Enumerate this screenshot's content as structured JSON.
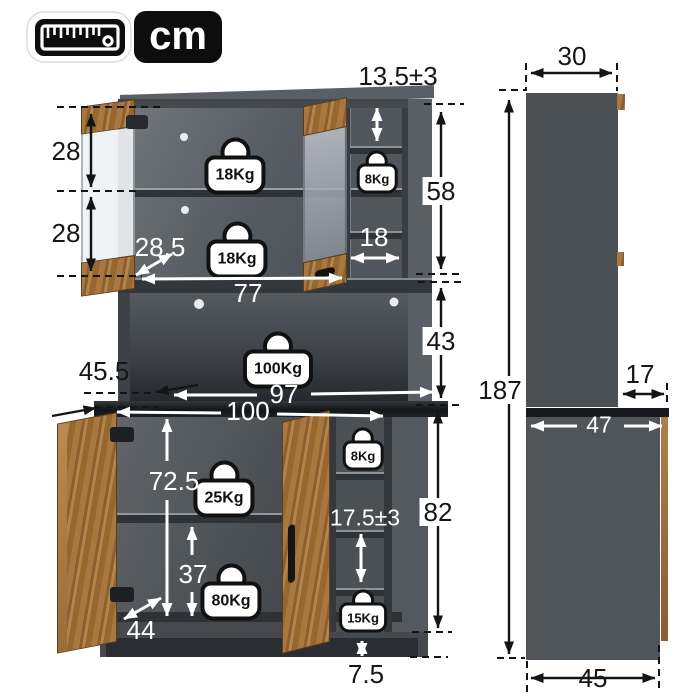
{
  "unit_badge": {
    "ruler_icon": "ruler-icon",
    "unit": "cm"
  },
  "front_view": {
    "dims": {
      "top_cubby_height": "13.5±3",
      "upper_section_height_a": "28",
      "upper_section_height_b": "28",
      "hutch_shelf_depth": "28.5",
      "hutch_interior_width": "77",
      "cubby_width": "18",
      "hutch_height": "58",
      "open_section_height": "43",
      "countertop_depth": "45.5",
      "counter_back_width": "97",
      "overall_width": "100",
      "base_interior_height": "72.5",
      "base_shelf_height": "37",
      "base_interior_depth": "44",
      "side_cubby_height": "17.5±3",
      "base_height": "82",
      "toe_kick_height": "7.5"
    },
    "weights": {
      "upper_shelf_a": "18Kg",
      "upper_shelf_b": "18Kg",
      "upper_cubby": "8Kg",
      "countertop": "100Kg",
      "base_shelf_a": "25Kg",
      "base_shelf_b": "80Kg",
      "side_cubby_top": "8Kg",
      "side_cubby_bottom": "15Kg"
    }
  },
  "side_view": {
    "dims": {
      "upper_depth": "30",
      "total_height": "187",
      "counter_overhang": "17",
      "counter_depth": "47",
      "base_depth": "45"
    }
  },
  "colors": {
    "cabinet_gray": "#4a4f55",
    "counter_black": "#1b1e21",
    "wood_brown": "#9c6b3a",
    "annotation_black": "#141414",
    "annotation_white": "#ffffff",
    "badge_black": "#0d0d0d"
  }
}
